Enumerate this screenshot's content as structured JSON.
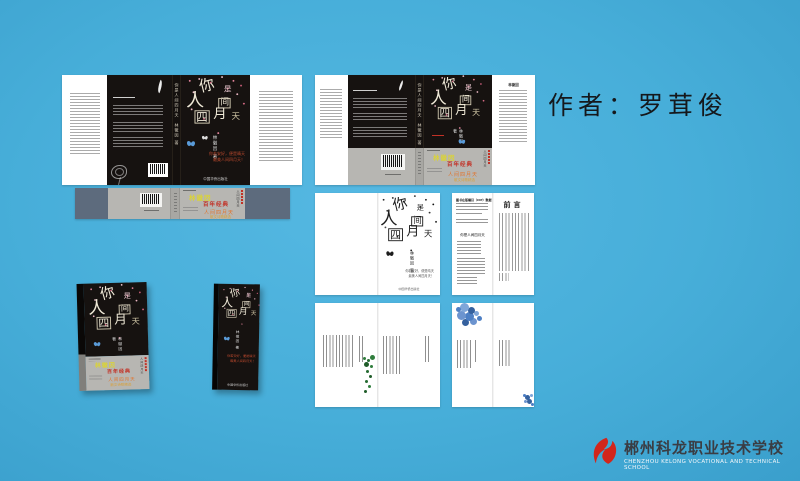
{
  "page": {
    "background_color": "#47aed9"
  },
  "caption": {
    "author_label": "作者：罗茸俊"
  },
  "book": {
    "title": "你是人间四月天",
    "title_chars": [
      "你",
      "是",
      "人",
      "间",
      "四",
      "月",
      "天"
    ],
    "author_byline": "林徽因 著",
    "spine_text": "你是人间四月天　林徽因 著",
    "tagline_line1": "你若安好，便是晴天",
    "tagline_line2": "最美人间四月天！",
    "publisher": "中国华侨出版社",
    "cover_color": "#161210"
  },
  "band": {
    "yellow_text": "林徽因",
    "red_text": "百年经典",
    "orange_text": "人间四月天",
    "sub_orange_text": "散文诗歌精选",
    "vertical_text": "人间四月天",
    "colors": {
      "yellow": "#d9d23a",
      "red": "#c23126",
      "orange": "#e2742c",
      "grey": "#b7b6b2",
      "slate": "#5d6b7d"
    }
  },
  "flap": {
    "heading": "林徽因"
  },
  "interior": {
    "preface_heading": "前言",
    "cip_heading": "图书在版编目（CIP）数据",
    "copyright_title": "你是人间四月天"
  },
  "logo": {
    "school_name_zh": "郴州科龙职业技术学校",
    "school_name_en": "CHENZHOU KELONG VOCATIONAL AND TECHNICAL SCHOOL",
    "accent_color": "#d2261c"
  }
}
